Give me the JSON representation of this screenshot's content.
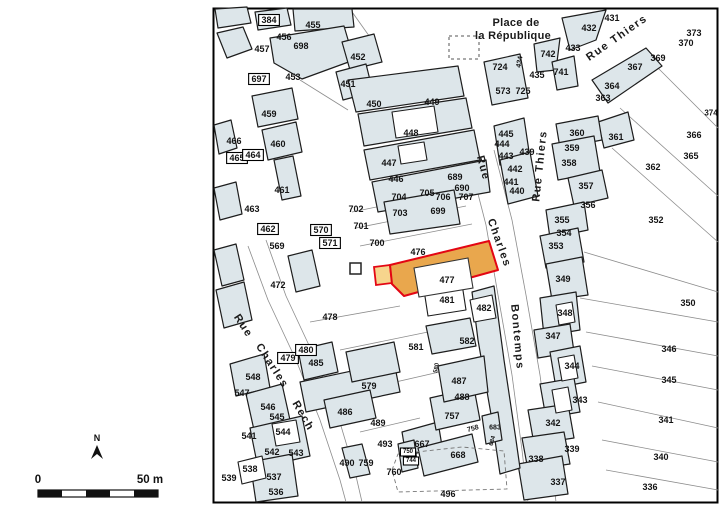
{
  "map": {
    "place_label": {
      "line1": "Place de",
      "line2": "la République"
    },
    "streets": [
      {
        "label": "Rue Thiers",
        "x": 617,
        "y": 38,
        "r": -35,
        "s": 11
      },
      {
        "label": "Rue Thiers",
        "x": 540,
        "y": 166,
        "r": -84,
        "s": 11
      },
      {
        "label": "Rue",
        "x": 483,
        "y": 168,
        "r": 75,
        "s": 11
      },
      {
        "label": "Charles",
        "x": 499,
        "y": 243,
        "r": 70,
        "s": 11
      },
      {
        "label": "Bontemps",
        "x": 517,
        "y": 337,
        "r": 85,
        "s": 11
      },
      {
        "label": "Rue",
        "x": 243,
        "y": 326,
        "r": 57,
        "s": 11
      },
      {
        "label": "Charles",
        "x": 272,
        "y": 366,
        "r": 57,
        "s": 11
      },
      {
        "label": "Rech",
        "x": 303,
        "y": 416,
        "r": 60,
        "s": 11
      }
    ],
    "parcels": [
      {
        "n": "384",
        "x": 269,
        "y": 20,
        "boxed": true
      },
      {
        "n": "455",
        "x": 313,
        "y": 25
      },
      {
        "n": "456",
        "x": 284,
        "y": 37
      },
      {
        "n": "457",
        "x": 262,
        "y": 49
      },
      {
        "n": "698",
        "x": 301,
        "y": 46
      },
      {
        "n": "697",
        "x": 259,
        "y": 79,
        "boxed": true
      },
      {
        "n": "453",
        "x": 293,
        "y": 77
      },
      {
        "n": "452",
        "x": 358,
        "y": 57
      },
      {
        "n": "451",
        "x": 348,
        "y": 84
      },
      {
        "n": "459",
        "x": 269,
        "y": 114
      },
      {
        "n": "450",
        "x": 374,
        "y": 104
      },
      {
        "n": "449",
        "x": 432,
        "y": 102
      },
      {
        "n": "448",
        "x": 411,
        "y": 133
      },
      {
        "n": "447",
        "x": 389,
        "y": 163
      },
      {
        "n": "446",
        "x": 396,
        "y": 179
      },
      {
        "n": "466",
        "x": 234,
        "y": 141
      },
      {
        "n": "460",
        "x": 278,
        "y": 144
      },
      {
        "n": "465",
        "x": 237,
        "y": 158,
        "boxed": true
      },
      {
        "n": "464",
        "x": 253,
        "y": 155,
        "boxed": true
      },
      {
        "n": "461",
        "x": 282,
        "y": 190
      },
      {
        "n": "463",
        "x": 252,
        "y": 209
      },
      {
        "n": "462",
        "x": 268,
        "y": 229,
        "boxed": true
      },
      {
        "n": "569",
        "x": 277,
        "y": 246
      },
      {
        "n": "570",
        "x": 321,
        "y": 230,
        "boxed": true
      },
      {
        "n": "571",
        "x": 330,
        "y": 243,
        "boxed": true
      },
      {
        "n": "472",
        "x": 278,
        "y": 285
      },
      {
        "n": "702",
        "x": 356,
        "y": 209
      },
      {
        "n": "701",
        "x": 361,
        "y": 226
      },
      {
        "n": "700",
        "x": 377,
        "y": 243
      },
      {
        "n": "703",
        "x": 400,
        "y": 213
      },
      {
        "n": "704",
        "x": 399,
        "y": 197
      },
      {
        "n": "705",
        "x": 427,
        "y": 193
      },
      {
        "n": "706",
        "x": 443,
        "y": 197
      },
      {
        "n": "707",
        "x": 466,
        "y": 197
      },
      {
        "n": "689",
        "x": 455,
        "y": 177
      },
      {
        "n": "690",
        "x": 462,
        "y": 188
      },
      {
        "n": "699",
        "x": 438,
        "y": 211
      },
      {
        "n": "476",
        "x": 418,
        "y": 252
      },
      {
        "n": "477",
        "x": 447,
        "y": 280
      },
      {
        "n": "481",
        "x": 447,
        "y": 300
      },
      {
        "n": "482",
        "x": 484,
        "y": 308
      },
      {
        "n": "478",
        "x": 330,
        "y": 317
      },
      {
        "n": "479",
        "x": 288,
        "y": 358,
        "boxed": true
      },
      {
        "n": "480",
        "x": 306,
        "y": 350,
        "boxed": true
      },
      {
        "n": "485",
        "x": 316,
        "y": 363
      },
      {
        "n": "581",
        "x": 416,
        "y": 347
      },
      {
        "n": "582",
        "x": 467,
        "y": 341
      },
      {
        "n": "580",
        "x": 437,
        "y": 368,
        "r": -80,
        "s": 6
      },
      {
        "n": "579",
        "x": 369,
        "y": 386
      },
      {
        "n": "486",
        "x": 345,
        "y": 412
      },
      {
        "n": "487",
        "x": 459,
        "y": 381
      },
      {
        "n": "488",
        "x": 462,
        "y": 397
      },
      {
        "n": "757",
        "x": 452,
        "y": 416
      },
      {
        "n": "758",
        "x": 473,
        "y": 429,
        "r": -15,
        "s": 7
      },
      {
        "n": "683",
        "x": 495,
        "y": 428,
        "s": 7
      },
      {
        "n": "684",
        "x": 493,
        "y": 441,
        "r": -75,
        "s": 6
      },
      {
        "n": "667",
        "x": 422,
        "y": 444
      },
      {
        "n": "668",
        "x": 458,
        "y": 455
      },
      {
        "n": "489",
        "x": 378,
        "y": 423
      },
      {
        "n": "493",
        "x": 385,
        "y": 444
      },
      {
        "n": "759",
        "x": 366,
        "y": 463
      },
      {
        "n": "760",
        "x": 394,
        "y": 472
      },
      {
        "n": "750",
        "x": 408,
        "y": 452,
        "s": 6,
        "boxed": true
      },
      {
        "n": "744",
        "x": 411,
        "y": 461,
        "s": 6,
        "boxed": true
      },
      {
        "n": "490",
        "x": 347,
        "y": 463
      },
      {
        "n": "496",
        "x": 448,
        "y": 494
      },
      {
        "n": "548",
        "x": 253,
        "y": 377
      },
      {
        "n": "547",
        "x": 242,
        "y": 393
      },
      {
        "n": "546",
        "x": 268,
        "y": 407
      },
      {
        "n": "545",
        "x": 277,
        "y": 417
      },
      {
        "n": "544",
        "x": 283,
        "y": 432
      },
      {
        "n": "541",
        "x": 249,
        "y": 436
      },
      {
        "n": "542",
        "x": 272,
        "y": 452
      },
      {
        "n": "543",
        "x": 296,
        "y": 453
      },
      {
        "n": "538",
        "x": 250,
        "y": 469
      },
      {
        "n": "539",
        "x": 229,
        "y": 478
      },
      {
        "n": "537",
        "x": 274,
        "y": 477
      },
      {
        "n": "536",
        "x": 276,
        "y": 492
      },
      {
        "n": "724",
        "x": 500,
        "y": 67
      },
      {
        "n": "434",
        "x": 520,
        "y": 62,
        "r": -80,
        "s": 7
      },
      {
        "n": "742",
        "x": 548,
        "y": 54
      },
      {
        "n": "741",
        "x": 561,
        "y": 72
      },
      {
        "n": "435",
        "x": 537,
        "y": 75
      },
      {
        "n": "573",
        "x": 503,
        "y": 91
      },
      {
        "n": "725",
        "x": 523,
        "y": 91
      },
      {
        "n": "431",
        "x": 612,
        "y": 18
      },
      {
        "n": "432",
        "x": 589,
        "y": 28
      },
      {
        "n": "433",
        "x": 573,
        "y": 48
      },
      {
        "n": "373",
        "x": 694,
        "y": 33
      },
      {
        "n": "370",
        "x": 686,
        "y": 43
      },
      {
        "n": "369",
        "x": 658,
        "y": 58
      },
      {
        "n": "367",
        "x": 635,
        "y": 67
      },
      {
        "n": "364",
        "x": 612,
        "y": 86
      },
      {
        "n": "363",
        "x": 603,
        "y": 98
      },
      {
        "n": "374",
        "x": 711,
        "y": 113,
        "s": 8
      },
      {
        "n": "361",
        "x": 616,
        "y": 137
      },
      {
        "n": "366",
        "x": 694,
        "y": 135
      },
      {
        "n": "365",
        "x": 691,
        "y": 156
      },
      {
        "n": "362",
        "x": 653,
        "y": 167
      },
      {
        "n": "352",
        "x": 656,
        "y": 220
      },
      {
        "n": "360",
        "x": 577,
        "y": 133
      },
      {
        "n": "359",
        "x": 572,
        "y": 148
      },
      {
        "n": "358",
        "x": 569,
        "y": 163
      },
      {
        "n": "357",
        "x": 586,
        "y": 186
      },
      {
        "n": "356",
        "x": 588,
        "y": 205
      },
      {
        "n": "355",
        "x": 562,
        "y": 220
      },
      {
        "n": "354",
        "x": 564,
        "y": 233
      },
      {
        "n": "353",
        "x": 556,
        "y": 246
      },
      {
        "n": "445",
        "x": 506,
        "y": 134
      },
      {
        "n": "444",
        "x": 502,
        "y": 144
      },
      {
        "n": "443",
        "x": 506,
        "y": 156
      },
      {
        "n": "439",
        "x": 527,
        "y": 152
      },
      {
        "n": "442",
        "x": 515,
        "y": 169
      },
      {
        "n": "441",
        "x": 511,
        "y": 182
      },
      {
        "n": "440",
        "x": 517,
        "y": 191
      },
      {
        "n": "349",
        "x": 563,
        "y": 279
      },
      {
        "n": "348",
        "x": 565,
        "y": 313
      },
      {
        "n": "347",
        "x": 553,
        "y": 336
      },
      {
        "n": "344",
        "x": 572,
        "y": 366
      },
      {
        "n": "343",
        "x": 580,
        "y": 400
      },
      {
        "n": "342",
        "x": 553,
        "y": 423
      },
      {
        "n": "339",
        "x": 572,
        "y": 449
      },
      {
        "n": "338",
        "x": 536,
        "y": 459
      },
      {
        "n": "337",
        "x": 558,
        "y": 482
      },
      {
        "n": "341",
        "x": 666,
        "y": 420
      },
      {
        "n": "340",
        "x": 661,
        "y": 457
      },
      {
        "n": "336",
        "x": 650,
        "y": 487
      },
      {
        "n": "350",
        "x": 688,
        "y": 303
      },
      {
        "n": "346",
        "x": 669,
        "y": 349
      },
      {
        "n": "345",
        "x": 669,
        "y": 380
      }
    ],
    "highlight": {
      "number": "477"
    },
    "north": {
      "label": "N"
    },
    "scale_bar": {
      "start_label": "0",
      "end_label": "50 m"
    },
    "colors": {
      "building_fill": "#dde6ea",
      "building_stroke": "#1d1d1d",
      "boundary_line": "#8c8c8c",
      "frame": "#000000",
      "highlight_fill": "#e9a74d",
      "highlight_stroke": "#e30613",
      "highlight_pale_fill": "#f6d58d",
      "label_color": "#141414"
    }
  }
}
